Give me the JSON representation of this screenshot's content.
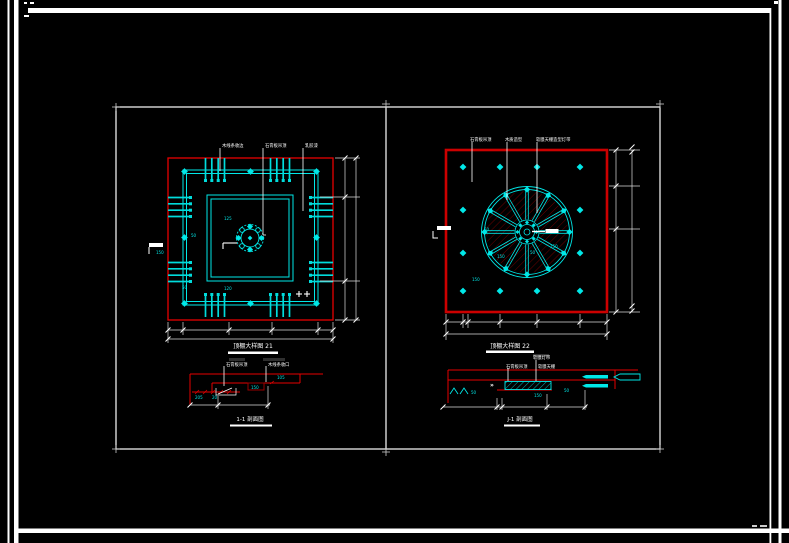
{
  "sheet": {
    "background": "#000000",
    "border_color": "#ffffff"
  },
  "colors": {
    "cyan": "#00e8e8",
    "red": "#e60000",
    "dark_red": "#9a0000",
    "white": "#ffffff",
    "dim_line": "#e0e0e0"
  },
  "left_plan": {
    "title": "顶棚大样图 21",
    "leader_labels": [
      "木线条收边",
      "石膏板吊顶",
      "乳胶漆"
    ],
    "dim_texts": [
      "125",
      "50",
      "150",
      "50",
      "120"
    ]
  },
  "left_section": {
    "title": "1-1 剖面图",
    "leader_labels": [
      "石膏板吊顶",
      "木线条收口"
    ],
    "dim_texts": [
      "205",
      "20",
      "150",
      "105"
    ]
  },
  "right_plan": {
    "title": "顶棚大样图 22",
    "leader_labels": [
      "石膏板吊顶",
      "木质造型",
      "软膜天棚造型灯带"
    ],
    "dim_texts": [
      "50",
      "150",
      "50",
      "150",
      "150"
    ]
  },
  "right_section": {
    "title": "J-1 剖面图",
    "leader_labels": [
      "软膜灯带",
      "软膜天棚",
      "石膏板吊顶"
    ],
    "chevron": "»",
    "dim_texts": [
      "50",
      "150",
      "50"
    ]
  }
}
